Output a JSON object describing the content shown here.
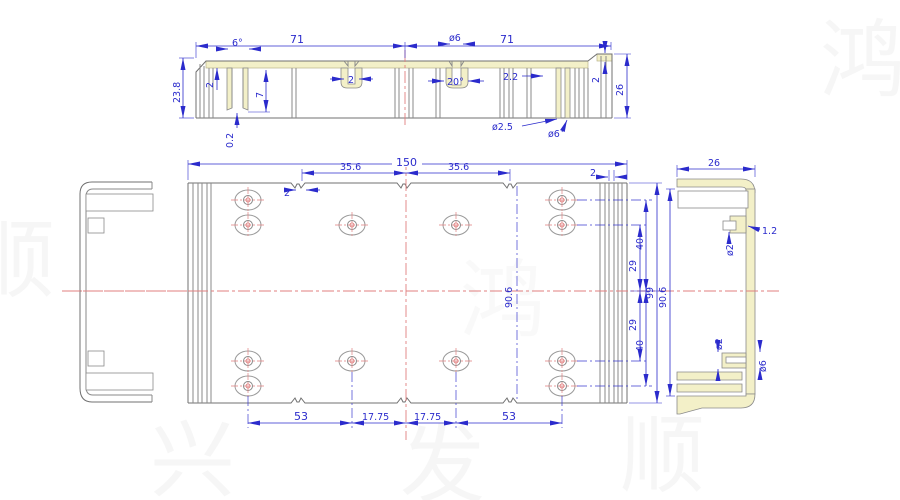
{
  "drawing": {
    "title": "aluminum-enclosure-profile-drawing",
    "colors": {
      "dimension_blue": "#2b2bcc",
      "outline_gray": "#8a8a8a",
      "section_fill_yellow": "#f3f0c8",
      "centerline_red": "#e07f7f",
      "background": "#ffffff",
      "watermark_gray": "#9a9a9a"
    },
    "top": {
      "width_left": "71",
      "width_right": "71",
      "taper_angle": "6°",
      "channel_dia": "ø6",
      "channel_angle": "20°",
      "slot_width": "2",
      "height_left": "23.8",
      "top_wall": "2",
      "boss_depth": "7",
      "gap": "0.2",
      "lip_inset": "2.2",
      "lip_height": "2",
      "height_right": "26",
      "screw_hole_minor": "ø2.5",
      "screw_hole_major": "ø6"
    },
    "front": {
      "overall_width": "150",
      "groove_pitch_left": "35.6",
      "groove_pitch_right": "35.6",
      "groove_width": "2",
      "wall_slot": "2",
      "row_outer_top": "40",
      "row_inner_top": "29",
      "overall_height": "99",
      "row_inner_bottom": "29",
      "row_outer_bottom": "40",
      "inner_height": "90.6",
      "col_left": "53",
      "col_mid_left": "17.75",
      "col_mid_right": "17.75",
      "col_right": "53"
    },
    "right": {
      "width": "26",
      "inner_height": "90.6",
      "boss_hole_top": "ø2",
      "boss_lip": "1.2",
      "boss_hole_bottom": "ø2",
      "boss_outer": "ø6"
    },
    "watermark": [
      "鸿",
      "顺",
      "兴",
      "发",
      "顺",
      "鸿"
    ]
  }
}
